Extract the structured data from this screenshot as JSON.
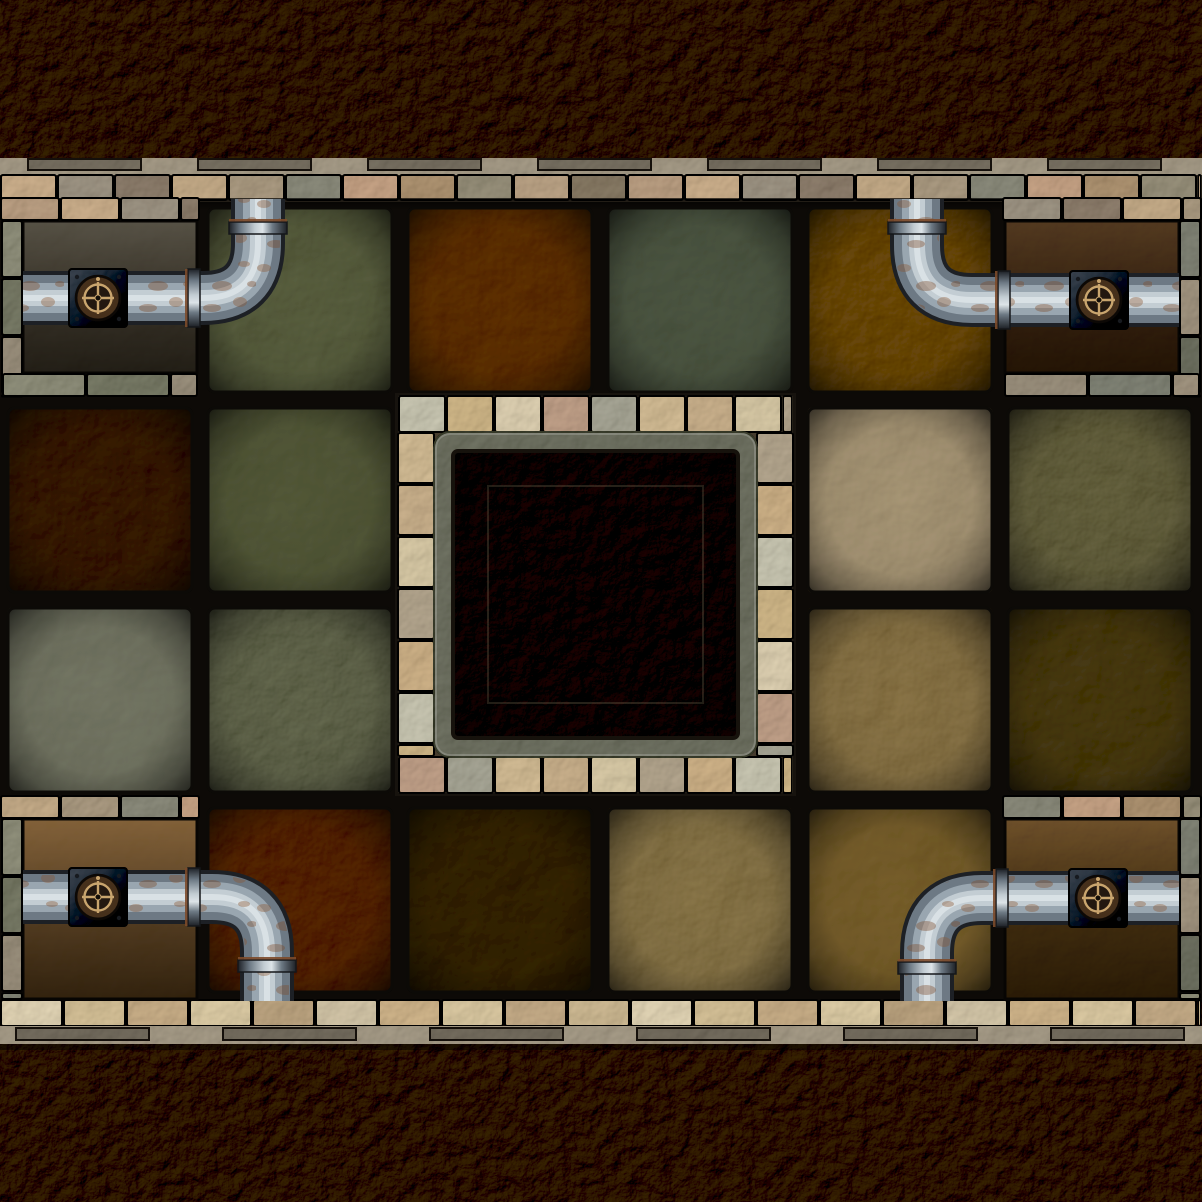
{
  "meta": {
    "title": "Dungeon tile map — stone chamber with corner pipes, valves and central pit",
    "width": 1202,
    "height": 1202
  },
  "palette": {
    "outer_rock": "#463d2e",
    "pit_rock": "#3b3327",
    "gap": "#0d0a07",
    "mortar": "#453b2d",
    "coping": "#a39a89",
    "ledge": "#75776b",
    "frame_stone": "#8e8c7d",
    "pipe_dark": "#1d2025",
    "pipe_mid": "#6d7984",
    "pipe_hi": "#99a6b0",
    "pipe_light": "#c3cdd3",
    "pipe_spec": "#dde4e8",
    "rust": "#7c4a2a",
    "rust_light": "#8a5630",
    "valve_plate_light": "#545a62",
    "valve_plate_dark": "#24272c",
    "valve_gold": "#c9a56e",
    "valve_ring": "#46301b",
    "valve_hub": "#231810"
  },
  "map": {
    "room": {
      "y": 200,
      "h": 802,
      "tile_size": 200,
      "cols": 6,
      "rows": 4
    },
    "tiles": [
      {
        "r": 0,
        "c": 1,
        "color": "#646852",
        "v": 0
      },
      {
        "r": 0,
        "c": 2,
        "color": "#684a31",
        "v": 1
      },
      {
        "r": 0,
        "c": 3,
        "color": "#5d6456",
        "v": 2
      },
      {
        "r": 0,
        "c": 4,
        "color": "#71583c",
        "v": 3
      },
      {
        "r": 1,
        "c": 0,
        "color": "#4e4133",
        "v": 1
      },
      {
        "r": 1,
        "c": 1,
        "color": "#626650",
        "v": 2
      },
      {
        "r": 1,
        "c": 4,
        "color": "#a4957a",
        "v": 0
      },
      {
        "r": 1,
        "c": 5,
        "color": "#6c6951",
        "v": 3
      },
      {
        "r": 2,
        "c": 0,
        "color": "#7b7d6e",
        "v": 2
      },
      {
        "r": 2,
        "c": 1,
        "color": "#6a6d5a",
        "v": 3
      },
      {
        "r": 2,
        "c": 4,
        "color": "#8b7957",
        "v": 1
      },
      {
        "r": 2,
        "c": 5,
        "color": "#584f3e",
        "v": 0
      },
      {
        "r": 3,
        "c": 1,
        "color": "#61442c",
        "v": 3
      },
      {
        "r": 3,
        "c": 2,
        "color": "#4c443a",
        "v": 0
      },
      {
        "r": 3,
        "c": 3,
        "color": "#8a7a58",
        "v": 1
      },
      {
        "r": 3,
        "c": 4,
        "color": "#7e6a49",
        "v": 2
      }
    ],
    "pit": {
      "x": 398,
      "y": 396,
      "w": 395,
      "h": 397,
      "brick": 36,
      "ledge": 20,
      "colors": [
        "#c1bfad",
        "#c8b28a",
        "#d4c8ad",
        "#ba9e8a",
        "#a4a395",
        "#cab694",
        "#c2ac8d",
        "#cfc2a3",
        "#afa38f",
        "#c6ad89"
      ]
    },
    "wall_top": {
      "colors": [
        "#b59d85",
        "#c4ab8d",
        "#9c9486",
        "#8e8173",
        "#bea88a",
        "#a79984",
        "#8c8c7f",
        "#bfa087",
        "#aa9377",
        "#96907e",
        "#b6a188",
        "#897e6d"
      ],
      "notches": {
        "y": 159,
        "h": 11,
        "w": 113,
        "xs": [
          28,
          198,
          368,
          538,
          708,
          878,
          1048
        ]
      }
    },
    "wall_bottom": {
      "colors": [
        "#d8ccb0",
        "#ccba96",
        "#c1aa89",
        "#d4c5a3",
        "#b6a183",
        "#cbbfa5",
        "#c8b08c",
        "#d1c19f",
        "#bea889",
        "#c6b493"
      ],
      "notches": {
        "y": 1028,
        "h": 12,
        "w": 133,
        "xs": [
          16,
          223,
          430,
          637,
          844,
          1051
        ]
      }
    },
    "frame_colors": [
      "#8f8f7e",
      "#7c7e6e",
      "#999080",
      "#83857a",
      "#9f9483",
      "#74766a"
    ],
    "alcoves": [
      {
        "id": "top-left",
        "ix": 22,
        "iy": 220,
        "iw": 176,
        "ih": 154,
        "grad": [
          "#5b574d",
          "#2f2a23",
          "#0f0c08"
        ],
        "texture": "#5e594e",
        "strips": [
          {
            "dir": "h",
            "x": 0,
            "y": 198,
            "w": 200,
            "h": 22,
            "step": 60,
            "set": "wall"
          },
          {
            "dir": "v",
            "x": 2,
            "y": 220,
            "w": 20,
            "h": 178,
            "step": 58,
            "set": "frame"
          },
          {
            "dir": "h",
            "x": 2,
            "y": 374,
            "w": 196,
            "h": 22,
            "step": 84,
            "set": "frame"
          }
        ]
      },
      {
        "id": "top-right",
        "ix": 1004,
        "iy": 220,
        "iw": 176,
        "ih": 154,
        "grad": [
          "#57432f",
          "#2c2017",
          "#120c07"
        ],
        "texture": "#5d4730",
        "strips": [
          {
            "dir": "h",
            "x": 1002,
            "y": 198,
            "w": 200,
            "h": 22,
            "step": 60,
            "set": "wall"
          },
          {
            "dir": "v",
            "x": 1180,
            "y": 220,
            "w": 20,
            "h": 178,
            "step": 58,
            "set": "frame"
          },
          {
            "dir": "h",
            "x": 1004,
            "y": 374,
            "w": 196,
            "h": 22,
            "step": 84,
            "set": "frame"
          }
        ]
      },
      {
        "id": "bottom-left",
        "ix": 22,
        "iy": 818,
        "iw": 176,
        "ih": 182,
        "grad": [
          "#8a6a47",
          "#4a3827",
          "#150e08"
        ],
        "texture": "#7d6143",
        "strips": [
          {
            "dir": "h",
            "x": 0,
            "y": 796,
            "w": 200,
            "h": 22,
            "step": 60,
            "set": "wall"
          },
          {
            "dir": "v",
            "x": 2,
            "y": 818,
            "w": 20,
            "h": 182,
            "step": 58,
            "set": "frame"
          }
        ]
      },
      {
        "id": "bottom-right",
        "ix": 1004,
        "iy": 818,
        "iw": 176,
        "ih": 182,
        "grad": [
          "#755a3d",
          "#352818",
          "#130d08"
        ],
        "texture": "#6a5137",
        "strips": [
          {
            "dir": "h",
            "x": 1002,
            "y": 796,
            "w": 200,
            "h": 22,
            "step": 60,
            "set": "wall"
          },
          {
            "dir": "v",
            "x": 1180,
            "y": 818,
            "w": 20,
            "h": 182,
            "step": 58,
            "set": "frame"
          }
        ]
      }
    ],
    "pipes": [
      {
        "id": "top-left",
        "path": "M 23 298 H 203 Q 258 298 258 243 V 199",
        "collars": [
          [
            194,
            298,
            "v"
          ],
          [
            258,
            228,
            "h"
          ]
        ],
        "valve": [
          98,
          298
        ]
      },
      {
        "id": "top-right",
        "path": "M 1179 300 H 972 Q 917 300 917 245 V 199",
        "collars": [
          [
            1004,
            300,
            "v"
          ],
          [
            917,
            228,
            "h"
          ]
        ],
        "valve": [
          1099,
          300
        ]
      },
      {
        "id": "bottom-left",
        "path": "M 23 897 H 212 Q 267 897 267 952 V 1001",
        "collars": [
          [
            194,
            897,
            "v"
          ],
          [
            267,
            966,
            "h"
          ]
        ],
        "valve": [
          98,
          897
        ]
      },
      {
        "id": "bottom-right",
        "path": "M 1179 898 H 982 Q 927 898 927 953 V 1001",
        "collars": [
          [
            1002,
            898,
            "v"
          ],
          [
            927,
            968,
            "h"
          ]
        ],
        "valve": [
          1098,
          898
        ]
      }
    ]
  }
}
